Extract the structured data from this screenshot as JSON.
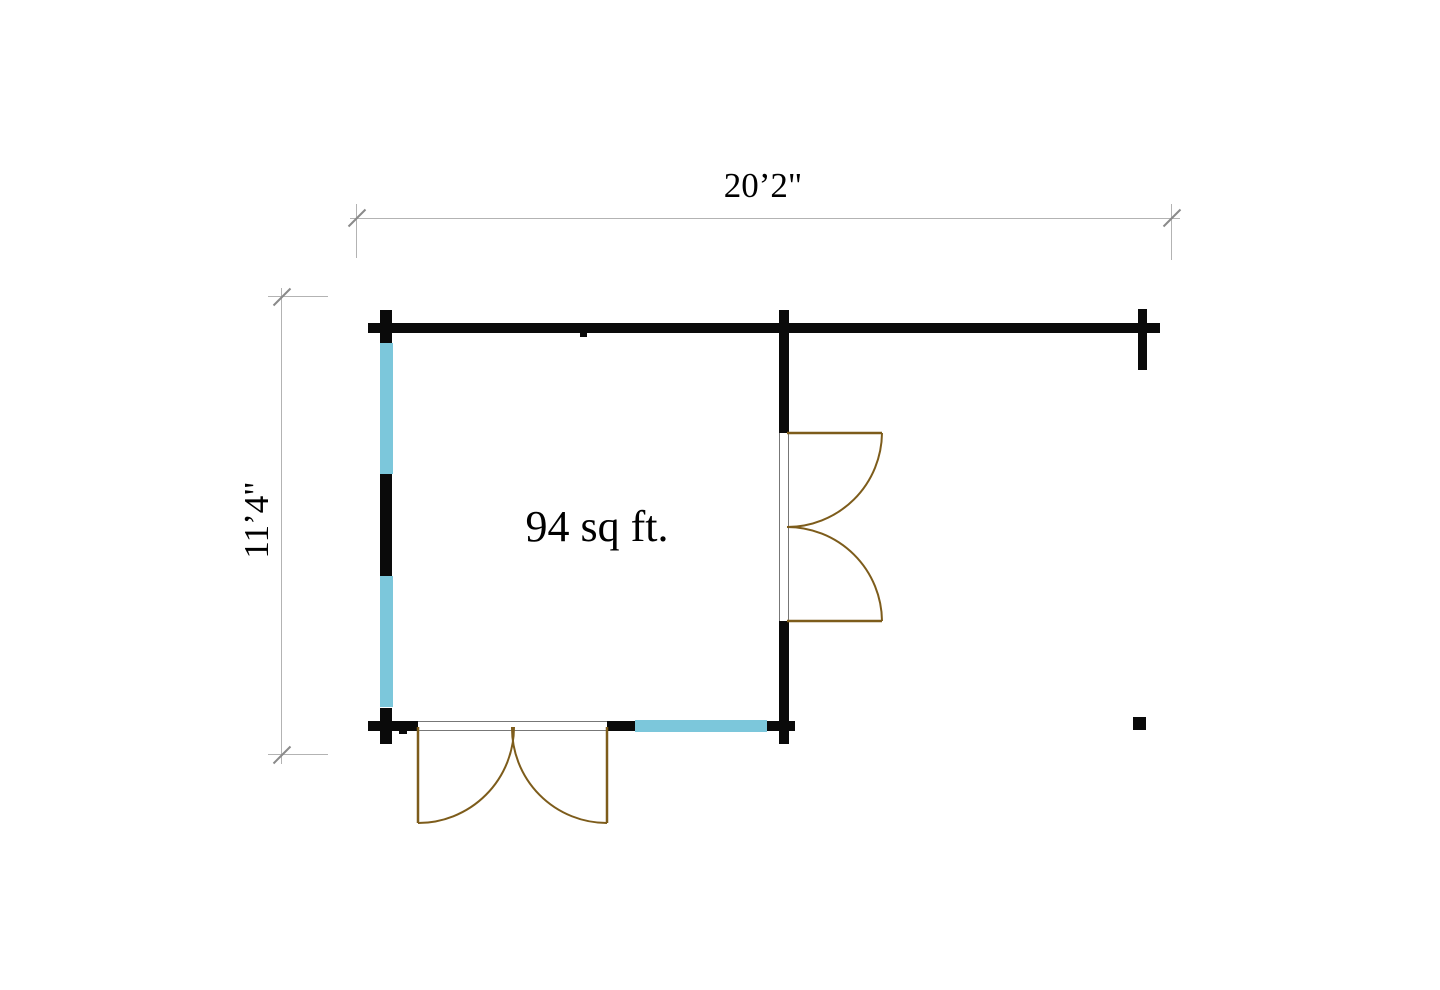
{
  "plan": {
    "area_label": "94 sq ft.",
    "width_dimension": "20’2\"",
    "height_dimension": "11’4\""
  },
  "legend": {
    "wall_meaning": "wall",
    "window_meaning": "window",
    "door_meaning": "double-door-swing"
  },
  "colors": {
    "background": "#ffffff",
    "wall": "#0a0a0a",
    "window": "#7cc7db",
    "door": "#7d5c1b",
    "door_frame": "#777777",
    "dimension_line": "#b3b3b3",
    "dimension_tick": "#8a8a8a",
    "text": "#000000"
  }
}
